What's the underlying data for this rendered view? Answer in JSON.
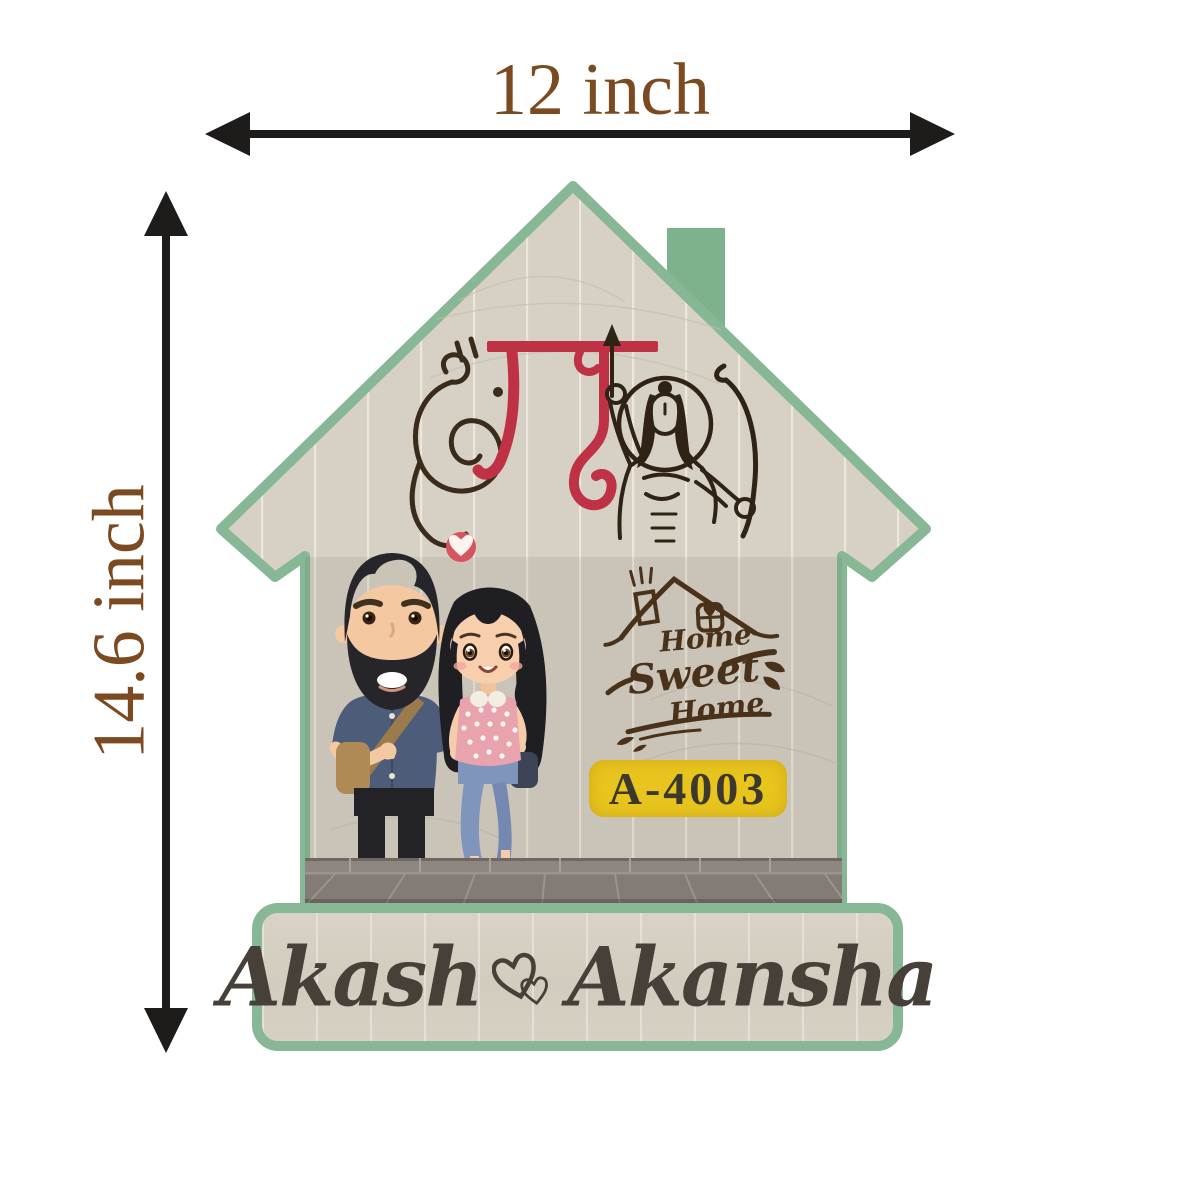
{
  "product_annotations": {
    "width_label": "12 inch",
    "height_label": "14.6 inch",
    "label_color": "#7b4a20",
    "arrow_color": "#1d1c1a"
  },
  "nameplate": {
    "shape": "house with chimney",
    "religious_text": "श्री राम",
    "home_sweet_home": {
      "line1": "Home",
      "line2": "Sweet",
      "line3": "Home"
    },
    "flat_number": "A-4003",
    "names": {
      "first": "Akash",
      "second": "Akansha"
    },
    "illustrations": [
      "couple-holding-hands",
      "lord-rama-line-art",
      "heart-badge",
      "home-sweet-home-logo",
      "tiled-floor"
    ],
    "colors": {
      "plate_border_green": "#87b795",
      "wood": "#d6d0c4",
      "flat_badge_yellow": "#e8c41e",
      "calligraphy_red": "#bf3245",
      "heart_red": "#d6545e",
      "engraving_brown": "#4a3119",
      "name_text": "#474039",
      "floor_gray": "#8e8681"
    }
  }
}
